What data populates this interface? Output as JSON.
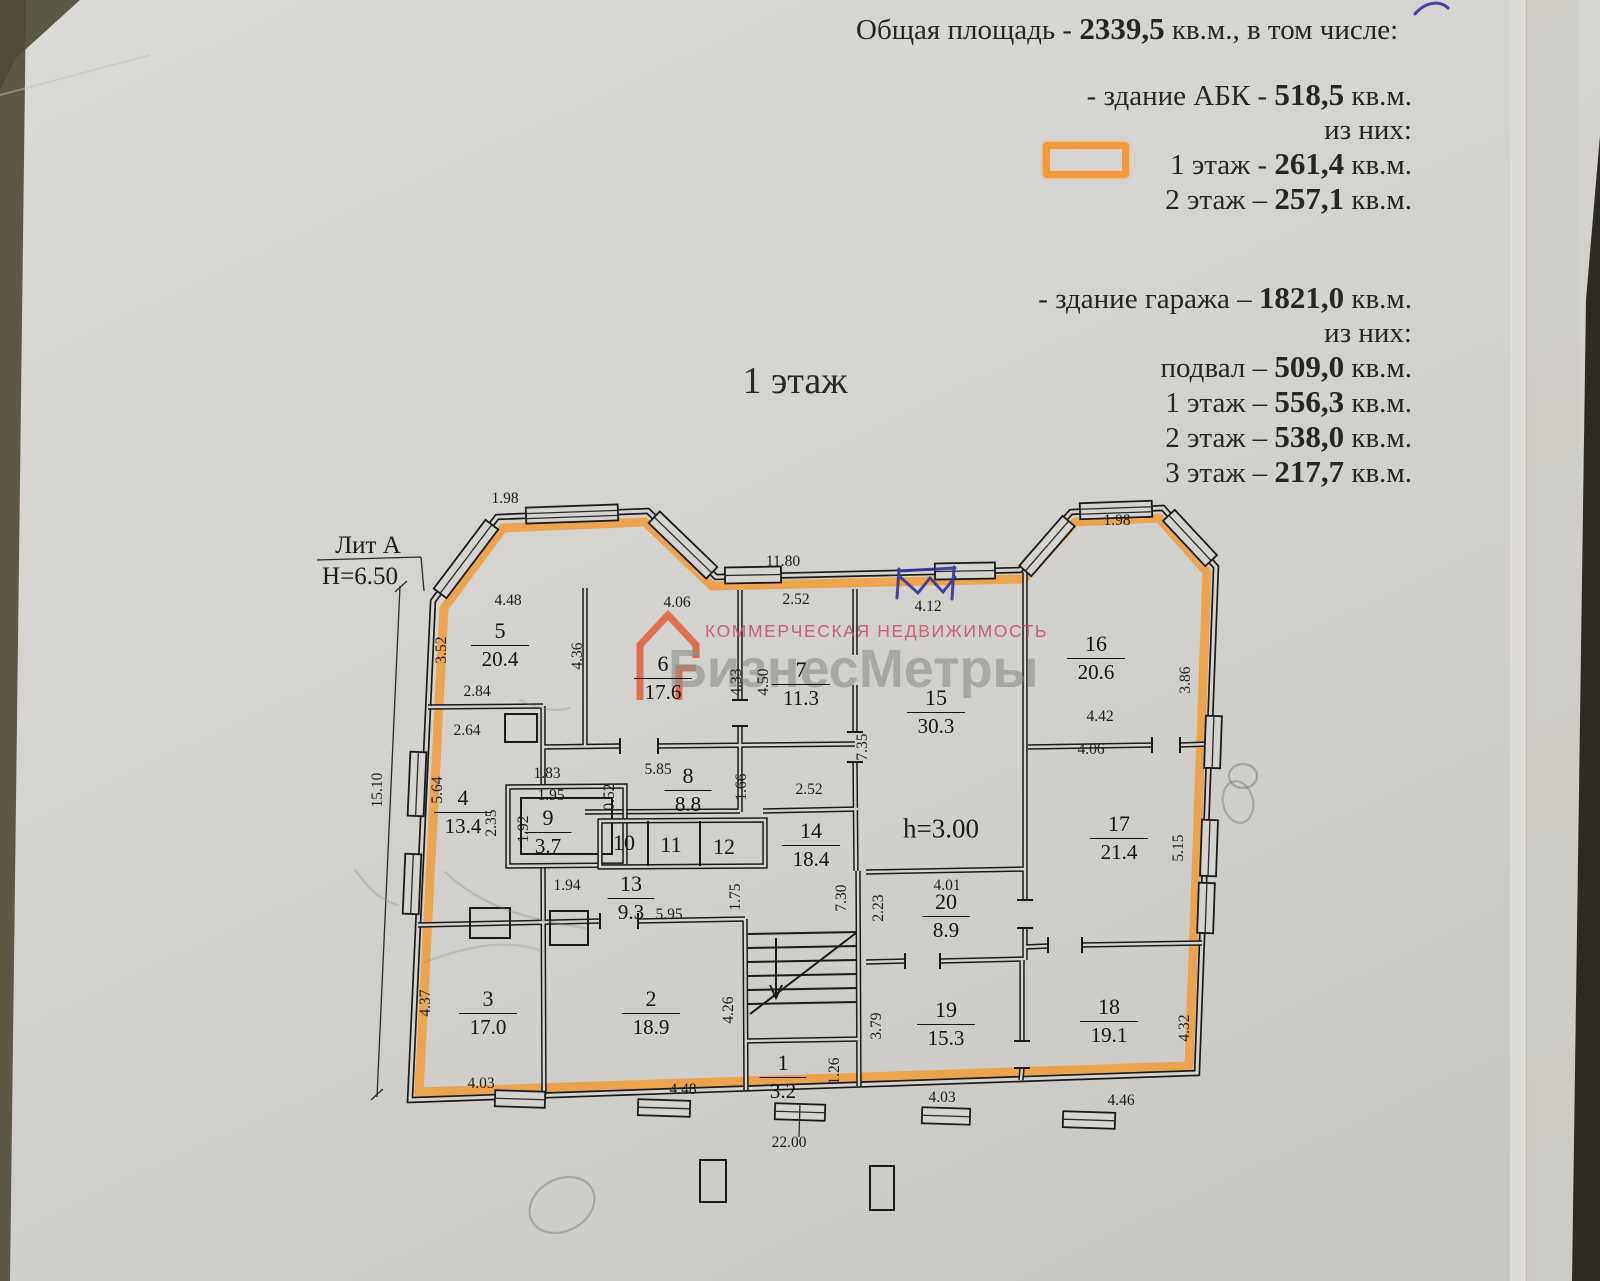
{
  "summary": {
    "total": {
      "pre": "Общая площадь  - ",
      "bold": "2339,5",
      "post": " кв.м., в том числе:"
    },
    "abk": {
      "pre": "- здание АБК  - ",
      "bold": "518,5",
      "post": " кв.м."
    },
    "of_them_1": "из них:",
    "abk_f1": {
      "pre": "1 этаж  - ",
      "bold": "261,4",
      "post": " кв.м."
    },
    "abk_f2": {
      "pre": "2 этаж – ",
      "bold": "257,1",
      "post": " кв.м."
    },
    "garage": {
      "pre": "- здание гаража – ",
      "bold": "1821,0",
      "post": " кв.м."
    },
    "of_them_2": "из них:",
    "g_base": {
      "pre": "подвал – ",
      "bold": "509,0",
      "post": " кв.м."
    },
    "g_f1": {
      "pre": "1 этаж  – ",
      "bold": "556,3",
      "post": " кв.м."
    },
    "g_f2": {
      "pre": "2 этаж  – ",
      "bold": "538,0",
      "post": " кв.м."
    },
    "g_f3": {
      "pre": "3 этаж  – ",
      "bold": "217,7",
      "post": " кв.м."
    }
  },
  "plan": {
    "title": "1 этаж",
    "lit": "Лит А",
    "height": "Н=6.50",
    "ceiling_height": "h=3.00",
    "rooms": [
      {
        "n": "5",
        "a": "20.4",
        "x": 500,
        "y": 645
      },
      {
        "n": "6",
        "a": "17.6",
        "x": 663,
        "y": 678
      },
      {
        "n": "7",
        "a": "11.3",
        "x": 801,
        "y": 684
      },
      {
        "n": "15",
        "a": "30.3",
        "x": 936,
        "y": 712
      },
      {
        "n": "16",
        "a": "20.6",
        "x": 1096,
        "y": 658
      },
      {
        "n": "4",
        "a": "13.4",
        "x": 463,
        "y": 812
      },
      {
        "n": "9",
        "a": "3.7",
        "x": 548,
        "y": 832
      },
      {
        "n": "8",
        "a": "8.8",
        "x": 688,
        "y": 790
      },
      {
        "n": "10",
        "a": "",
        "x": 624,
        "y": 843
      },
      {
        "n": "11",
        "a": "",
        "x": 671,
        "y": 845
      },
      {
        "n": "12",
        "a": "",
        "x": 724,
        "y": 847
      },
      {
        "n": "13",
        "a": "9.3",
        "x": 631,
        "y": 898
      },
      {
        "n": "14",
        "a": "18.4",
        "x": 811,
        "y": 845
      },
      {
        "n": "17",
        "a": "21.4",
        "x": 1119,
        "y": 838
      },
      {
        "n": "20",
        "a": "8.9",
        "x": 946,
        "y": 916
      },
      {
        "n": "19",
        "a": "15.3",
        "x": 946,
        "y": 1024
      },
      {
        "n": "18",
        "a": "19.1",
        "x": 1109,
        "y": 1021
      },
      {
        "n": "3",
        "a": "17.0",
        "x": 488,
        "y": 1013
      },
      {
        "n": "2",
        "a": "18.9",
        "x": 651,
        "y": 1013
      },
      {
        "n": "1",
        "a": "3.2",
        "x": 783,
        "y": 1077
      }
    ],
    "dims": [
      {
        "t": "1.98",
        "x": 505,
        "y": 499
      },
      {
        "t": "11.80",
        "x": 783,
        "y": 562
      },
      {
        "t": "1.98",
        "x": 1117,
        "y": 521
      },
      {
        "t": "4.48",
        "x": 508,
        "y": 601
      },
      {
        "t": "4.06",
        "x": 677,
        "y": 603
      },
      {
        "t": "2.52",
        "x": 796,
        "y": 600
      },
      {
        "t": "4.12",
        "x": 928,
        "y": 607
      },
      {
        "t": "3.52",
        "x": 442,
        "y": 650,
        "v": 1
      },
      {
        "t": "4.36",
        "x": 578,
        "y": 656,
        "v": 1
      },
      {
        "t": "4.33",
        "x": 737,
        "y": 682,
        "v": 1
      },
      {
        "t": "4.50",
        "x": 764,
        "y": 682,
        "v": 1
      },
      {
        "t": "7.35",
        "x": 863,
        "y": 747,
        "v": 1
      },
      {
        "t": "3.86",
        "x": 1186,
        "y": 680,
        "v": 1
      },
      {
        "t": "2.84",
        "x": 477,
        "y": 692
      },
      {
        "t": "2.64",
        "x": 467,
        "y": 731
      },
      {
        "t": "4.42",
        "x": 1100,
        "y": 717
      },
      {
        "t": "4.06",
        "x": 1091,
        "y": 750
      },
      {
        "t": "15.10",
        "x": 378,
        "y": 790,
        "v": 1
      },
      {
        "t": "5.64",
        "x": 438,
        "y": 790,
        "v": 1
      },
      {
        "t": "2.35",
        "x": 492,
        "y": 823,
        "v": 1
      },
      {
        "t": "1.83",
        "x": 547,
        "y": 774
      },
      {
        "t": "1.95",
        "x": 551,
        "y": 796
      },
      {
        "t": "1.92",
        "x": 524,
        "y": 829,
        "v": 1
      },
      {
        "t": "0.52",
        "x": 610,
        "y": 797,
        "v": 1
      },
      {
        "t": "5.85",
        "x": 658,
        "y": 770
      },
      {
        "t": "1.66",
        "x": 742,
        "y": 787,
        "v": 1
      },
      {
        "t": "2.52",
        "x": 809,
        "y": 790
      },
      {
        "t": "1.94",
        "x": 567,
        "y": 886
      },
      {
        "t": "5.95",
        "x": 669,
        "y": 915
      },
      {
        "t": "1.75",
        "x": 736,
        "y": 897,
        "v": 1
      },
      {
        "t": "7.30",
        "x": 842,
        "y": 898,
        "v": 1
      },
      {
        "t": "2.23",
        "x": 879,
        "y": 908,
        "v": 1
      },
      {
        "t": "4.01",
        "x": 947,
        "y": 886
      },
      {
        "t": "4.37",
        "x": 426,
        "y": 1003,
        "v": 1
      },
      {
        "t": "4.26",
        "x": 729,
        "y": 1010,
        "v": 1
      },
      {
        "t": "3.79",
        "x": 877,
        "y": 1026,
        "v": 1
      },
      {
        "t": "1.26",
        "x": 835,
        "y": 1071,
        "v": 1
      },
      {
        "t": "5.15",
        "x": 1179,
        "y": 848,
        "v": 1
      },
      {
        "t": "4.32",
        "x": 1185,
        "y": 1028,
        "v": 1
      },
      {
        "t": "4.03",
        "x": 481,
        "y": 1084
      },
      {
        "t": "4.48",
        "x": 683,
        "y": 1090
      },
      {
        "t": "4.03",
        "x": 942,
        "y": 1098
      },
      {
        "t": "4.46",
        "x": 1121,
        "y": 1101
      },
      {
        "t": "22.00",
        "x": 789,
        "y": 1143
      }
    ]
  },
  "watermark": {
    "tagline": "КОММЕРЧЕСКАЯ НЕДВИЖИМОСТЬ",
    "brand": "БизнесМетры"
  },
  "colors": {
    "highlight_orange": "#f2992f",
    "pen_blue": "#34349b",
    "watermark_pink": "#c4516b",
    "watermark_gray": "#8f8f8c"
  }
}
